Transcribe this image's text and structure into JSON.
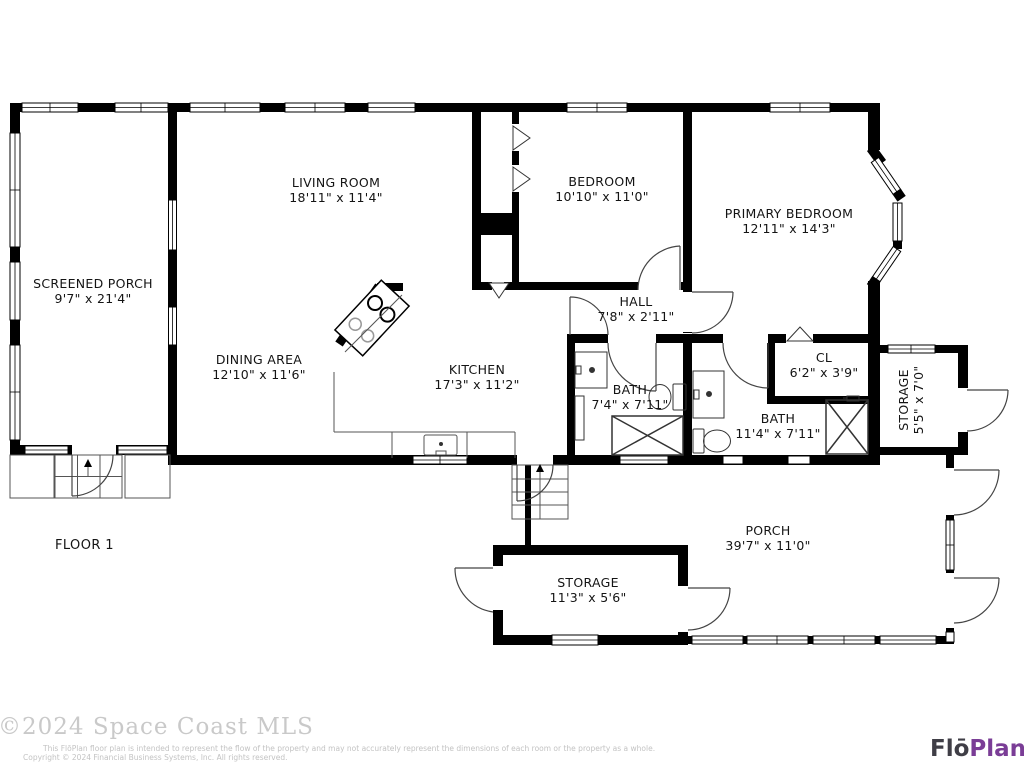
{
  "rooms": [
    {
      "id": "screened-porch",
      "name": "SCREENED PORCH",
      "dims": "9'7\" x 21'4\""
    },
    {
      "id": "living-room",
      "name": "LIVING ROOM",
      "dims": "18'11\" x 11'4\""
    },
    {
      "id": "bedroom",
      "name": "BEDROOM",
      "dims": "10'10\" x 11'0\""
    },
    {
      "id": "primary-bedroom",
      "name": "PRIMARY BEDROOM",
      "dims": "12'11\" x 14'3\""
    },
    {
      "id": "hall",
      "name": "HALL",
      "dims": "7'8\" x 2'11\""
    },
    {
      "id": "dining-area",
      "name": "DINING AREA",
      "dims": "12'10\" x 11'6\""
    },
    {
      "id": "kitchen",
      "name": "KITCHEN",
      "dims": "17'3\" x 11'2\""
    },
    {
      "id": "bath-hall",
      "name": "BATH",
      "dims": "7'4\" x 7'11\""
    },
    {
      "id": "closet",
      "name": "CL",
      "dims": "6'2\" x 3'9\""
    },
    {
      "id": "bath-primary",
      "name": "BATH",
      "dims": "11'4\" x 7'11\""
    },
    {
      "id": "storage-side",
      "name": "STORAGE",
      "dims": "5'5\" x 7'0\""
    },
    {
      "id": "porch",
      "name": "PORCH",
      "dims": "39'7\" x 11'0\""
    },
    {
      "id": "storage-under-porch",
      "name": "STORAGE",
      "dims": "11'3\" x 5'6\""
    }
  ],
  "floor_label": "FLOOR 1",
  "watermark": "©2024 Space Coast MLS",
  "disclaimer": {
    "line1": "This FlōPlan floor plan is intended to represent the flow of the property and may not accurately represent the dimensions of each room or the property as a whole.",
    "line2": "Copyright © 2024 Financial Business Systems, Inc. All rights reserved."
  },
  "logo": {
    "first": "Flō",
    "second": "Plan"
  },
  "colors": {
    "walls": "#000000",
    "logo_first": "#3f3e46",
    "logo_second": "#7a3d96",
    "watermark": "#c9c9c9",
    "disclaimer_text": "#c3c3c3"
  }
}
